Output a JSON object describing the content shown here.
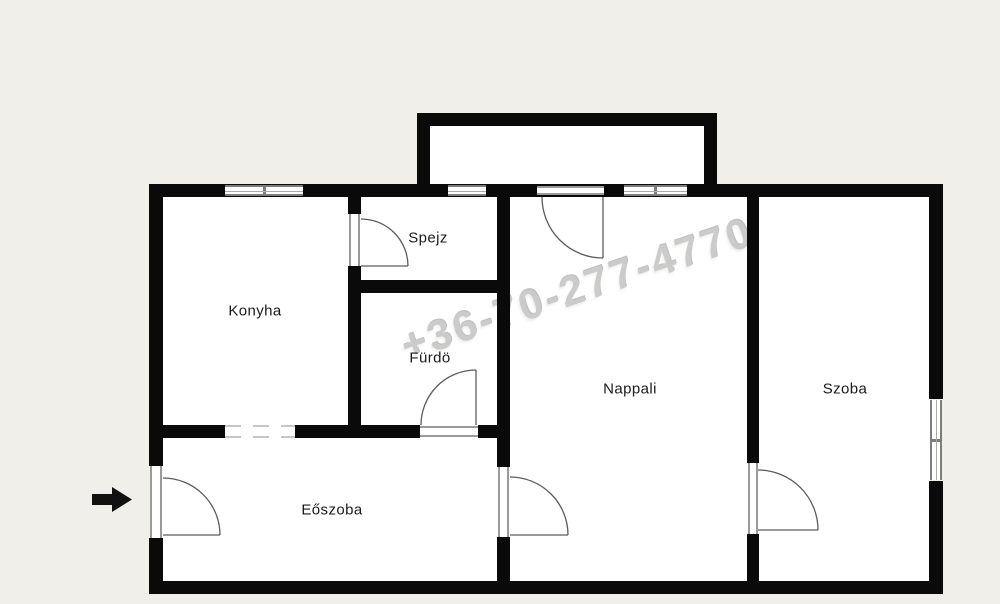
{
  "plan": {
    "type": "apartment-floor-plan",
    "rooms": {
      "konyha": {
        "label": "Konyha"
      },
      "spejz": {
        "label": "Spejz"
      },
      "furdo": {
        "label": "Fürdö"
      },
      "nappali": {
        "label": "Nappali"
      },
      "szoba": {
        "label": "Szoba"
      },
      "eoszoba": {
        "label": "Eőszoba"
      }
    }
  },
  "watermark": {
    "text": "+36-70-277-4770"
  },
  "icons": {
    "entrance_arrow": "black-right-arrow"
  },
  "colors": {
    "background": "#f0efea",
    "floor": "#ffffff",
    "wall": "#0a0a0a",
    "door_stroke": "#5c5c5c",
    "dash": "#c6c6c6",
    "label": "#1b1b1b",
    "watermark": "#cbcbcb"
  }
}
